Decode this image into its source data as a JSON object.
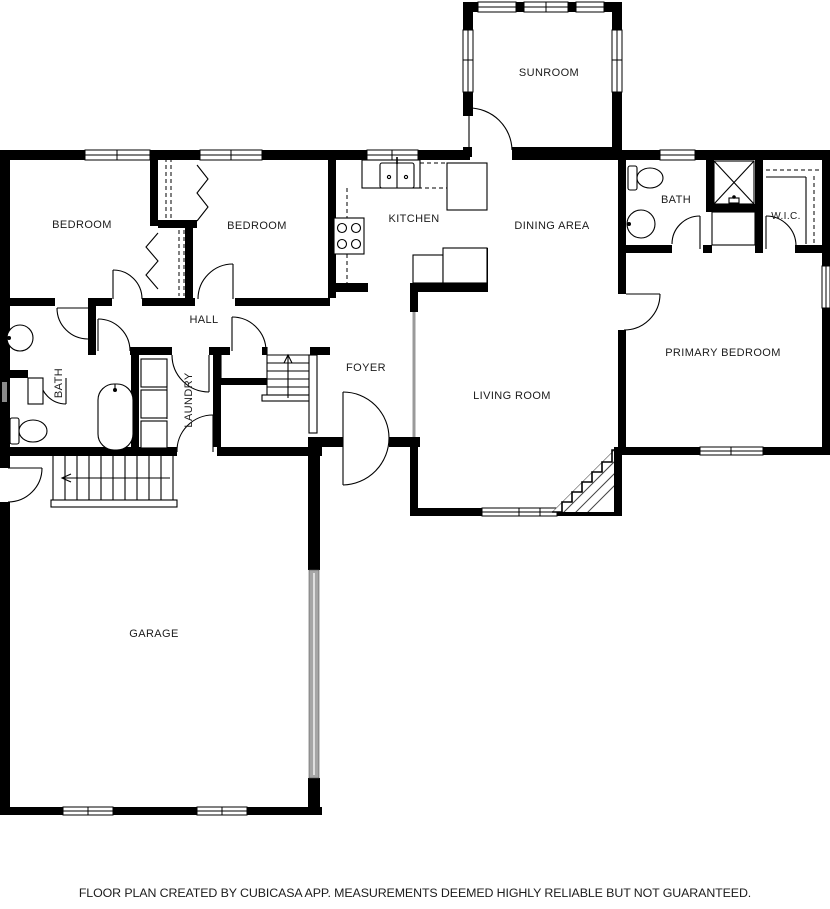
{
  "floor_plan": {
    "rooms": {
      "sunroom": "SUNROOM",
      "bedroom_left": "BEDROOM",
      "bedroom_middle": "BEDROOM",
      "kitchen": "KITCHEN",
      "dining_area": "DINING AREA",
      "bath_upper": "BATH",
      "wic": "W.I.C.",
      "primary_bedroom": "PRIMARY BEDROOM",
      "hall": "HALL",
      "bath_lower": "BATH",
      "laundry": "LAUNDRY",
      "foyer": "FOYER",
      "living_room": "LIVING ROOM",
      "garage": "GARAGE"
    },
    "footer": {
      "disclaimer": "FLOOR PLAN CREATED BY CUBICASA APP. MEASUREMENTS DEEMED HIGHLY RELIABLE BUT NOT GUARANTEED."
    },
    "colors": {
      "wall": "#000000",
      "background": "#ffffff",
      "garage_door": "#a6a6a6",
      "hatch": "#444444"
    }
  }
}
